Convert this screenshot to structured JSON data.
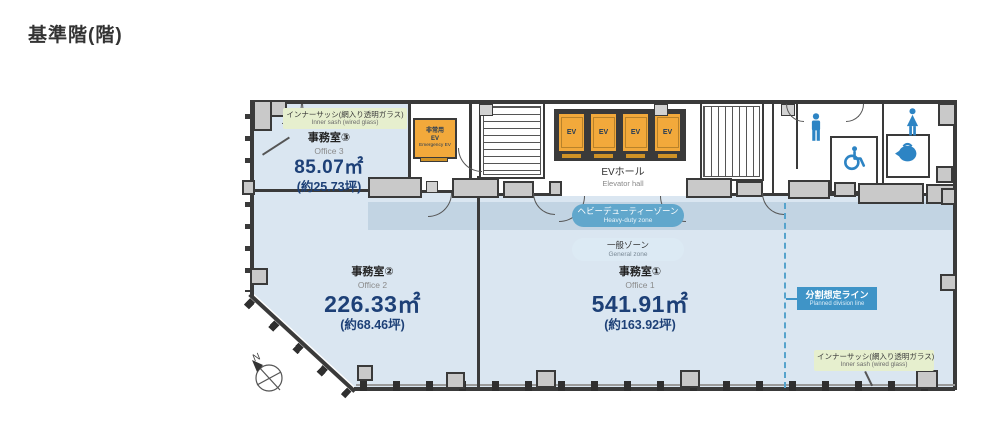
{
  "page": {
    "title": "基準階(階)"
  },
  "offices": {
    "office1": {
      "name_jp": "事務室①",
      "name_en": "Office 1",
      "area": "541.91㎡",
      "tsubo": "(約163.92坪)"
    },
    "office2": {
      "name_jp": "事務室②",
      "name_en": "Office 2",
      "area": "226.33㎡",
      "tsubo": "(約68.46坪)"
    },
    "office3": {
      "name_jp": "事務室③",
      "name_en": "Office 3",
      "area": "85.07㎡",
      "tsubo": "(約25.73坪)"
    }
  },
  "zones": {
    "heavy_duty": {
      "jp": "ヘビーデューティーゾーン",
      "en": "Heavy-duty zone"
    },
    "general": {
      "jp": "一般ゾーン",
      "en": "General zone"
    }
  },
  "annotations": {
    "inner_sash_top": {
      "jp": "インナーサッシ(網入り透明ガラス)",
      "en": "Inner sash (wired glass)"
    },
    "inner_sash_bottom": {
      "jp": "インナーサッシ(網入り透明ガラス)",
      "en": "Inner sash (wired glass)"
    },
    "division_line": {
      "jp": "分割想定ライン",
      "en": "Planned division line"
    }
  },
  "core": {
    "ev_hall": {
      "jp": "EVホール",
      "en": "Elevator hall"
    },
    "emergency_ev": {
      "jp_line1": "非常用",
      "jp_line2": "EV",
      "en": "Emergency EV"
    },
    "ev_label": "EV",
    "north_label": "N"
  },
  "colors": {
    "office_fill": "#dae6f1",
    "heavy_zone_fill": "#c2d4e3",
    "heavy_pill": "#61a7cc",
    "general_pill": "#dceaf4",
    "ev_orange": "#f2a93b",
    "label_green": "#e6efce",
    "division_blue": "#3f94c7",
    "icon_blue": "#2d84c4",
    "wall": "#3a3a3a",
    "area_text": "#1d4077"
  }
}
